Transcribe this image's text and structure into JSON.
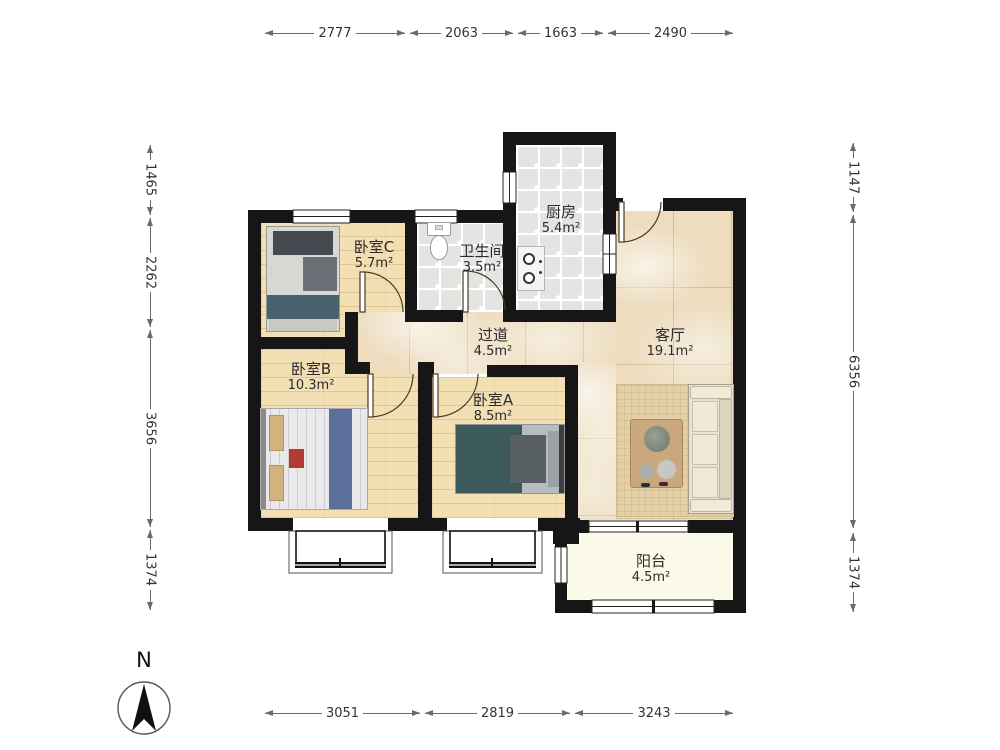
{
  "compass": {
    "label": "N"
  },
  "rooms": {
    "kitchen": {
      "name": "厨房",
      "area": "5.4m²"
    },
    "bathroom": {
      "name": "卫生间",
      "area": "3.5m²"
    },
    "bedroom_c": {
      "name": "卧室C",
      "area": "5.7m²"
    },
    "corridor": {
      "name": "过道",
      "area": "4.5m²"
    },
    "living": {
      "name": "客厅",
      "area": "19.1m²"
    },
    "bedroom_b": {
      "name": "卧室B",
      "area": "10.3m²"
    },
    "bedroom_a": {
      "name": "卧室A",
      "area": "8.5m²"
    },
    "balcony": {
      "name": "阳台",
      "area": "4.5m²"
    }
  },
  "dims": {
    "top": [
      "2777",
      "2063",
      "1663",
      "2490"
    ],
    "bottom": [
      "3051",
      "2819",
      "3243"
    ],
    "left": [
      "1465",
      "2262",
      "3656",
      "1374"
    ],
    "right": [
      "1147",
      "6356",
      "1374"
    ]
  },
  "colors": {
    "wall": "#161616",
    "wood_floor": "#f2e0b4",
    "tile_floor": "#e4e4e2",
    "marble_floor": "#eddcbe",
    "balcony_floor": "#fbfae9",
    "teal_bed": "#3c5a5c",
    "blue_runner": "#5d6f9b"
  }
}
